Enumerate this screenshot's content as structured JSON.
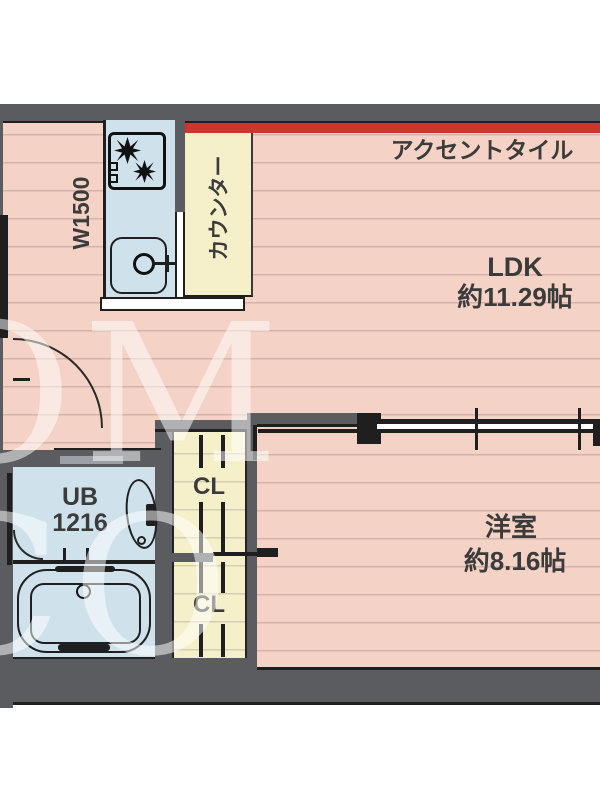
{
  "plan": {
    "watermark_text": "OM CO",
    "accent_tile_label": "アクセントタイル",
    "ldk": {
      "name": "LDK",
      "area": "約11.29帖"
    },
    "western_room": {
      "name": "洋室",
      "area": "約8.16帖"
    },
    "unit_bath": {
      "name": "UB",
      "size": "1216"
    },
    "closet_upper_label": "CL",
    "closet_lower_label": "CL",
    "kitchen_width_label": "W1500",
    "counter_label": "カウンター",
    "colors": {
      "floor_pink": "#f4d2c5",
      "wall_gray": "#5a5c60",
      "accent_red": "#cc372b",
      "closet_cream": "#f6f0ca",
      "bath_blue": "#cfe2ec",
      "line_black": "#1f1f1f",
      "watermark_white": "rgba(255,255,255,0.52)"
    }
  }
}
